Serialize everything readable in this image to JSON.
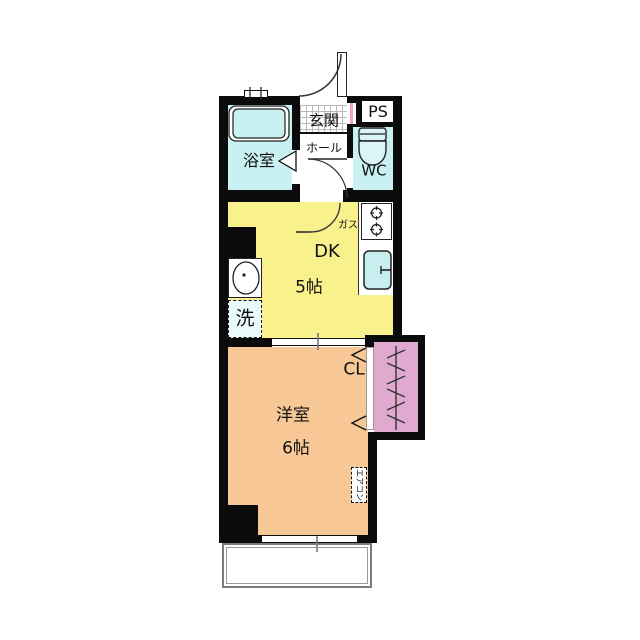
{
  "floorplan": {
    "entrance": {
      "label": "玄関"
    },
    "hall": {
      "label": "ホール"
    },
    "bathroom": {
      "label": "浴室"
    },
    "toilet": {
      "label": "WC"
    },
    "pipe_space": {
      "label": "PS"
    },
    "dining_kitchen": {
      "label": "DK",
      "size": "5帖"
    },
    "gas": {
      "label": "ガス"
    },
    "laundry": {
      "label": "洗"
    },
    "closet": {
      "label": "CL"
    },
    "western_room": {
      "label": "洋室",
      "size": "6帖"
    },
    "aircon": {
      "label": "エアコン"
    },
    "colors": {
      "wall": "#0b0b0b",
      "water_rooms": "#c9f1f3",
      "dining_kitchen": "#f8f18c",
      "western_room": "#f7c795",
      "closet": "#e0aad0",
      "meter_stripe": "#f0a2ca",
      "laundry_fill": "#eafafa"
    }
  }
}
